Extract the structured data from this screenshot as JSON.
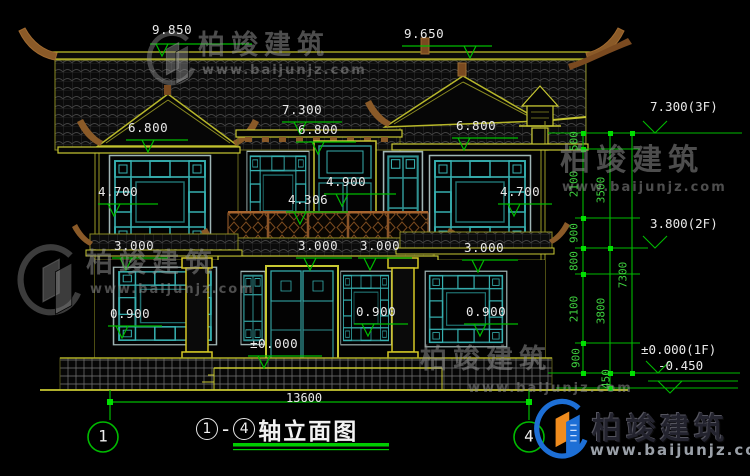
{
  "watermark": {
    "brand": "柏竣建筑",
    "url": "www.baijunjz.com"
  },
  "title": {
    "axis_start": "1",
    "dash": "-",
    "axis_end": "4",
    "name": "轴立面图"
  },
  "axis_bubbles": {
    "left": "1",
    "right": "4"
  },
  "dimensions": {
    "total_width": "13600",
    "levels": [
      "9.850",
      "9.650",
      "7.300",
      "6.800",
      "6.800",
      "6.800",
      "4.700",
      "4.700",
      "4.900",
      "4.306",
      "3.000",
      "3.000",
      "3.000",
      "3.000",
      "0.900",
      "0.900",
      "0.900",
      "±0.000"
    ],
    "floor_levels": [
      "7.300(3F)",
      "3.800(2F)",
      "±0.000(1F)",
      "-0.450"
    ],
    "chain_inner": [
      "500",
      "2100",
      "900",
      "800",
      "2100",
      "900"
    ],
    "chain_mid": [
      "3500",
      "3800"
    ],
    "chain_below_zero": "450",
    "chain_total": "7300"
  },
  "colors": {
    "dim_green": "#00bb00",
    "line_yellow": "#c8c832",
    "lattice_cyan": "#36b0b0",
    "wood_brown": "#8a5a28",
    "logo_blue": "#1d6fd6",
    "logo_orange": "#f08c1e"
  }
}
